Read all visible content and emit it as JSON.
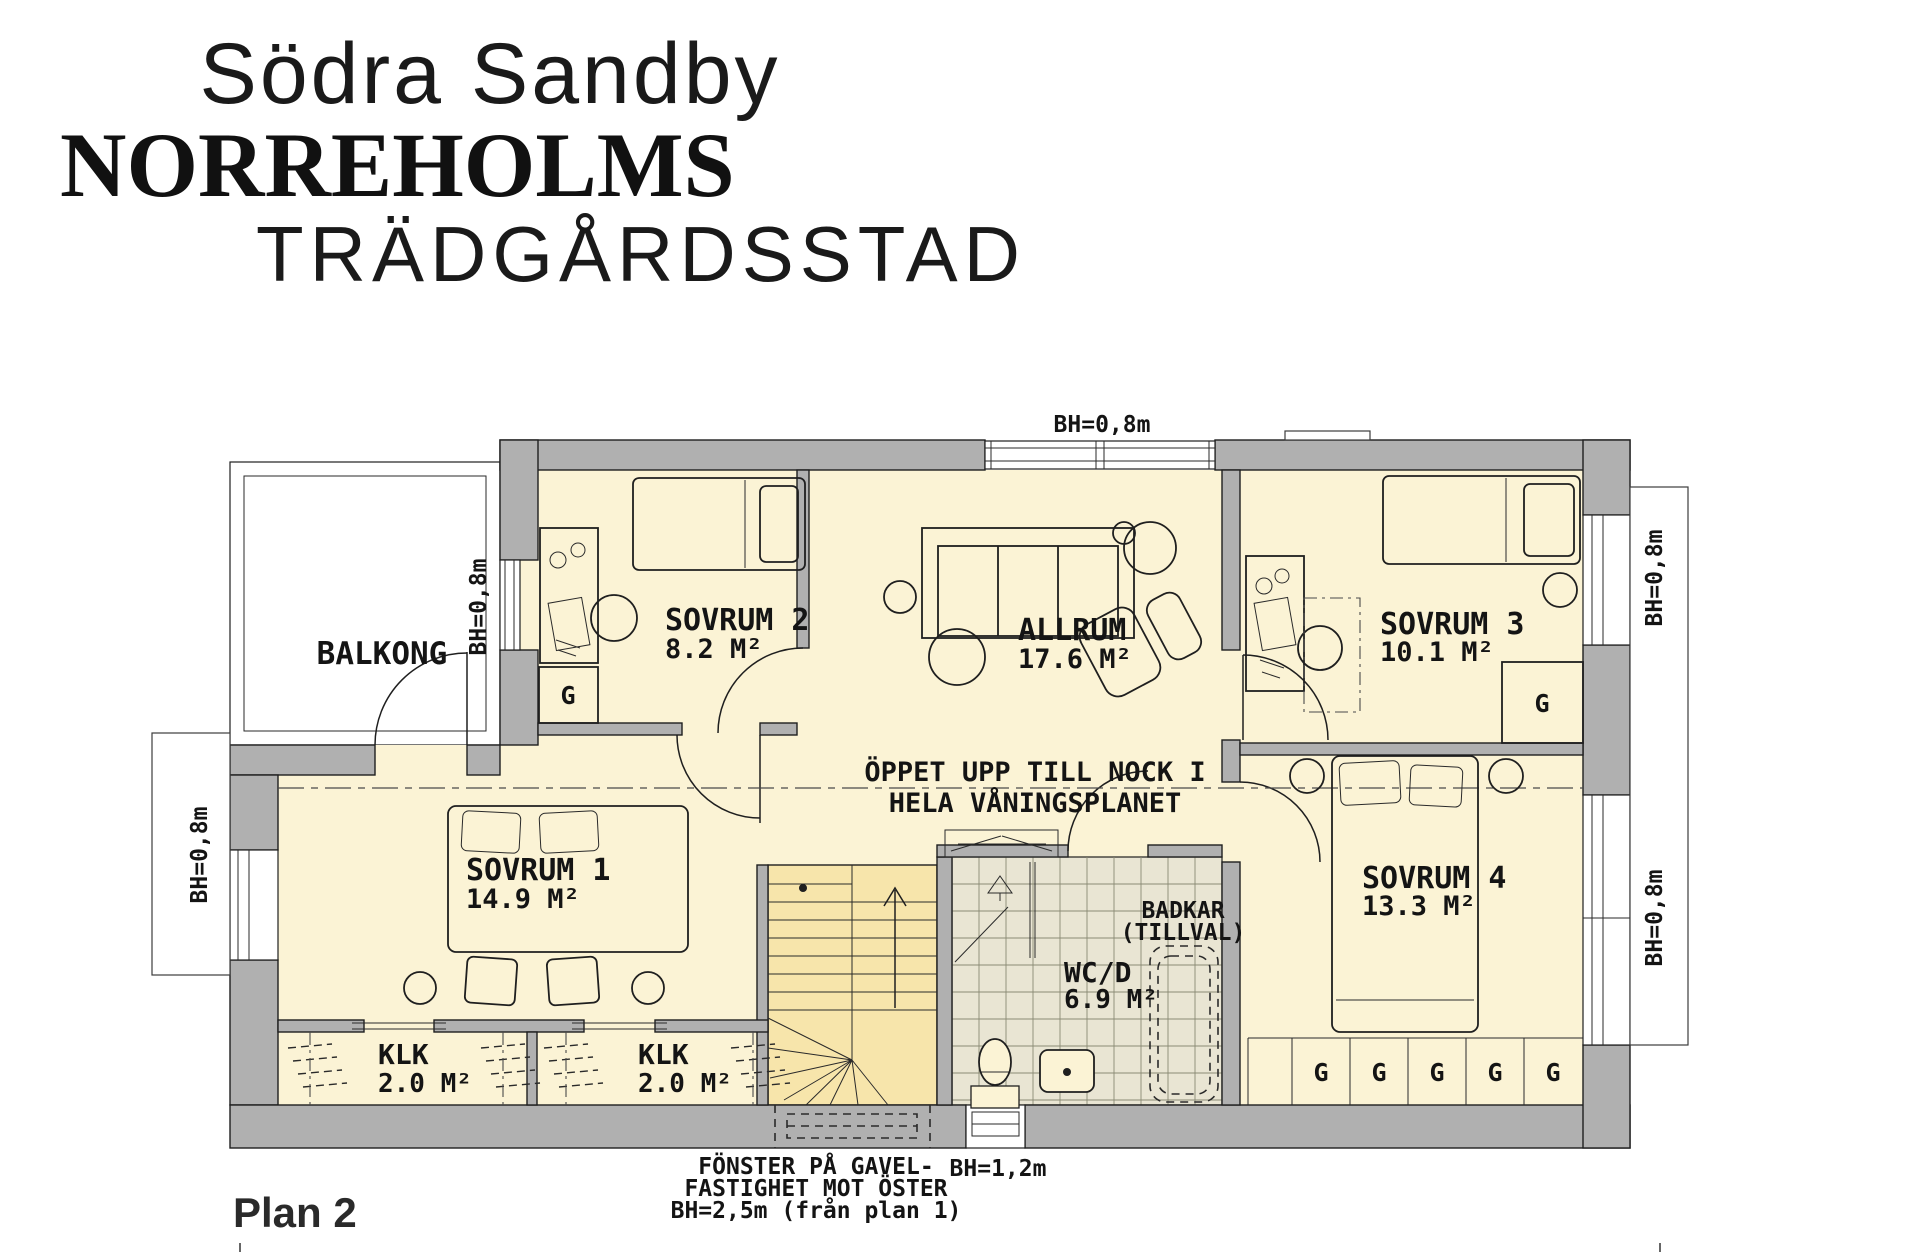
{
  "title": {
    "line1": "Södra Sandby",
    "line2": "NORREHOLMS",
    "line3": "TRÄDGÅRDSSTAD"
  },
  "plan_label": "Plan 2",
  "rooms": [
    {
      "id": "balkong",
      "name": "BALKONG",
      "area": ""
    },
    {
      "id": "sovrum2",
      "name": "SOVRUM 2",
      "area": "8.2 M²"
    },
    {
      "id": "allrum",
      "name": "ALLRUM",
      "area": "17.6 M²"
    },
    {
      "id": "sovrum3",
      "name": "SOVRUM 3",
      "area": "10.1 M²"
    },
    {
      "id": "sovrum1",
      "name": "SOVRUM 1",
      "area": "14.9 M²"
    },
    {
      "id": "sovrum4",
      "name": "SOVRUM 4",
      "area": "13.3 M²"
    },
    {
      "id": "klk1",
      "name": "KLK",
      "area": "2.0 M²"
    },
    {
      "id": "klk2",
      "name": "KLK",
      "area": "2.0 M²"
    },
    {
      "id": "wcd",
      "name": "WC/D",
      "area": "6.9 M²"
    }
  ],
  "annotations": {
    "open_line1": "ÖPPET UPP TILL NOCK I",
    "open_line2": "HELA VÅNINGSPLANET",
    "badkar_line1": "BADKAR",
    "badkar_line2": "(TILLVAL)",
    "window_note_line1": "FÖNSTER PÅ GAVEL-",
    "window_note_line2": "FASTIGHET MOT ÖSTER",
    "window_note_line3": "BH=2,5m (från plan 1)",
    "bh_08": "BH=0,8m",
    "bh_12": "BH=1,2m",
    "wardrobe": "G"
  },
  "colors": {
    "wall_gray": "#b0b0b0",
    "room_yellow": "#fbf3d5",
    "stairs_yellow": "#f7e5ab",
    "tile_gray": "#e9e5d3",
    "line_dark": "#1f1f1f"
  }
}
